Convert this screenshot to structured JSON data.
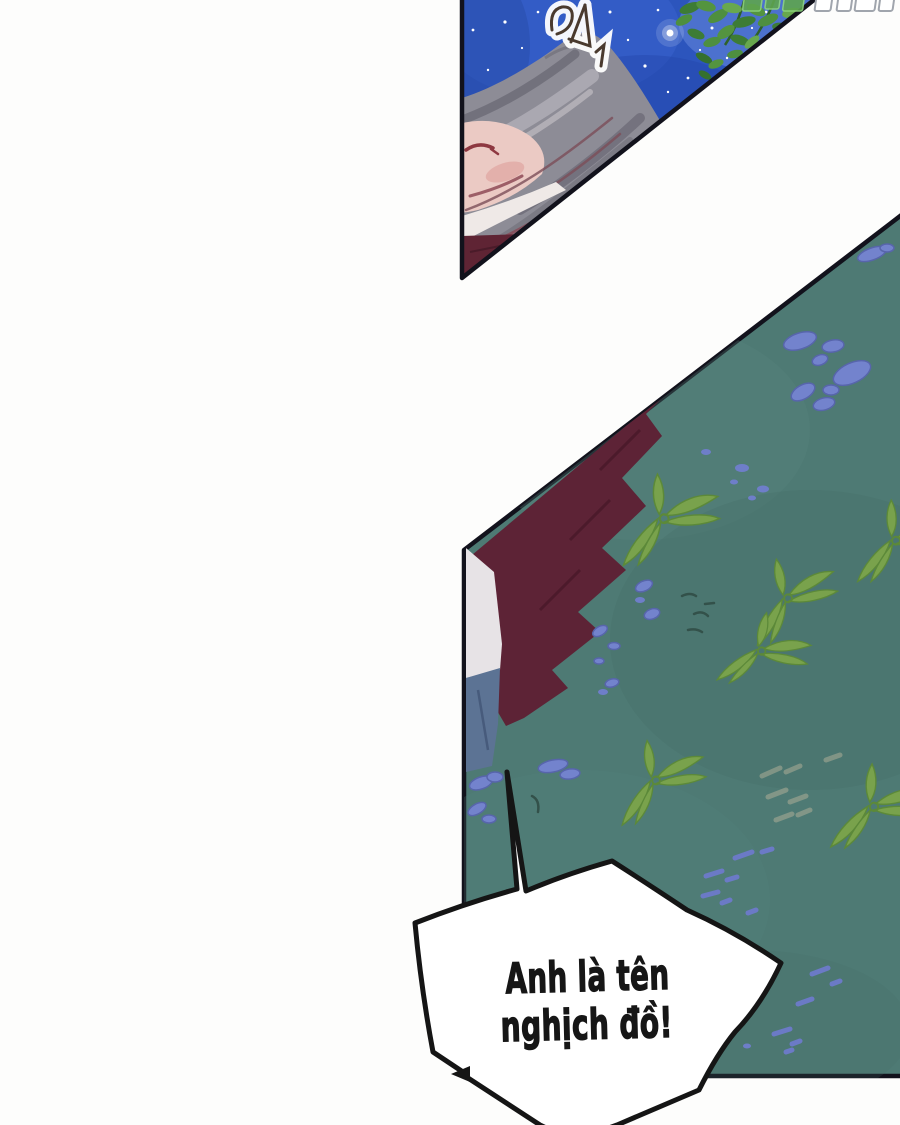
{
  "comic": {
    "speech_bubble": {
      "line1": "Anh là tên",
      "line2": "nghịch đồ!"
    }
  },
  "colors": {
    "page_background": "#fdfdfc",
    "panel_border": "#12121c",
    "sky_blue": "#2c55bd",
    "sky_light_glow": "#7e9ce8",
    "hair_gray": "#8d8c96",
    "skin_pink": "#ebcac4",
    "clothing_maroon": "#5f2434",
    "blanket_teal": "#4e7a74",
    "bamboo_leaf_green": "#79a24c",
    "flower_periwinkle": "#7383cd",
    "foliage_green": "#4e8f3f",
    "bubble_fill": "#ffffff",
    "text_color": "#161616"
  }
}
